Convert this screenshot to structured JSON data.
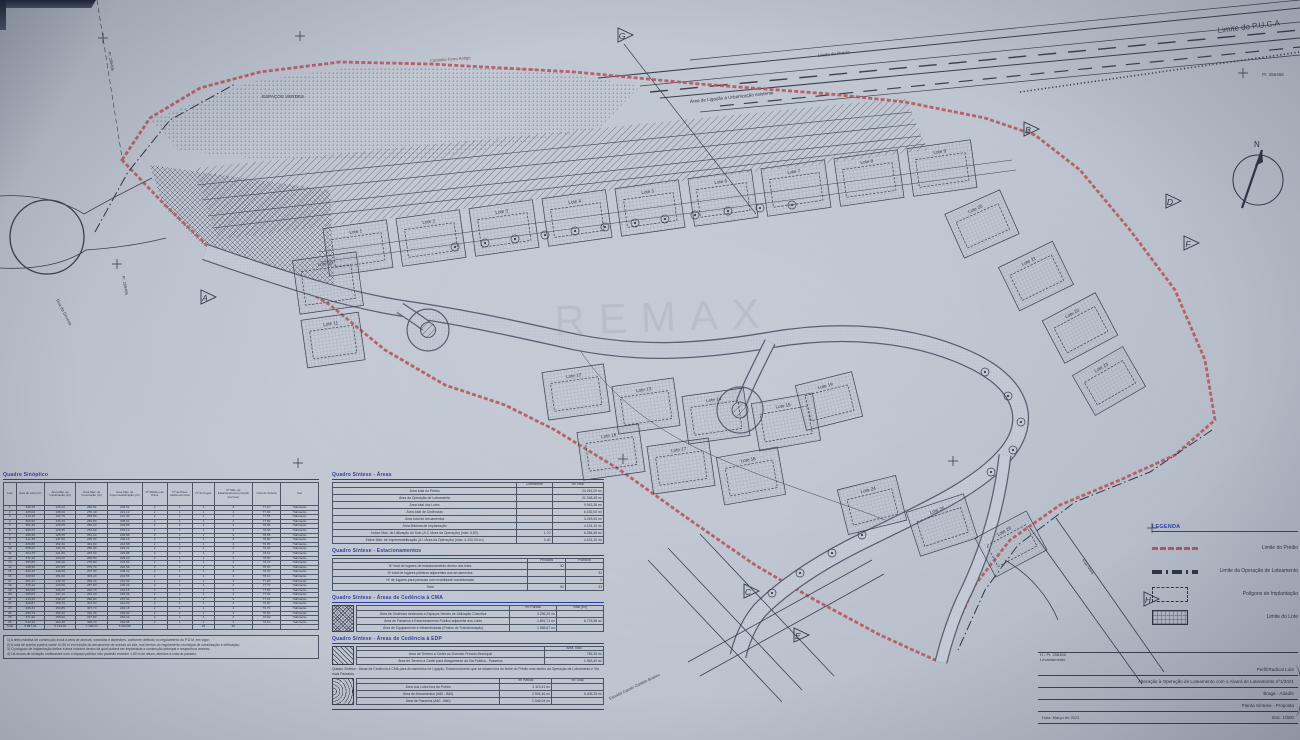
{
  "map": {
    "watermark": "REMAX",
    "north": "N",
    "labels": {
      "limite_puca": "Limite do P.U.C.A",
      "limite_predio": "Limite do Prédio",
      "caminho_ferro": "Caminho Ferro Antigo",
      "faixa_ligacao": "Área de Ligação à Urbanização existente",
      "espacos_verdes": "ESPAÇOS VERDES",
      "mark_topleft": "Pr. 256495",
      "mark_left": "Pr. 256495",
      "mark_topright": "Pr. 256466",
      "rua_esquerda": "Rua da Devesa",
      "estrada_baixo": "Estrada Camilo Castelo Branco",
      "rua_direita": "Rua Nova"
    },
    "section_markers": [
      "A",
      "B",
      "C",
      "D",
      "E",
      "F",
      "G",
      "H"
    ],
    "lots": [
      "Lote 1",
      "Lote 2",
      "Lote 3",
      "Lote 4",
      "Lote 5",
      "Lote 6",
      "Lote 7",
      "Lote 8",
      "Lote 9",
      "Lote 10",
      "Lote 11",
      "Lote 12",
      "Lote 13",
      "Lote 14",
      "Lote 15",
      "Lote 16",
      "Lote 17",
      "Lote 18",
      "Lote 19",
      "Lote 20",
      "Lote 21",
      "Lote 22",
      "Lote 23",
      "Lote 24",
      "Lote 25",
      "Lote 26"
    ]
  },
  "quadro_sinoptico": {
    "title": "Quadro Sinóptico",
    "headers": [
      "Lote",
      "Área do Lote (m²)",
      "Área Máx. de Implantação (m²)",
      "Área Máx. de Construção (m²)",
      "Área Máx. de Impermeabilização (m²)",
      "Nº Máximo de Pisos",
      "Nº de Pisos abaixo da Cota",
      "Nº de Fogos",
      "Nº Máx. de Estacionamento privado (por lote)",
      "Cota de Soleira",
      "Uso"
    ],
    "rows": [
      [
        "1",
        "348,16",
        "145,32",
        "290,64",
        "232,51",
        "2",
        "1",
        "1",
        "2",
        "77,10",
        "Habitação"
      ],
      [
        "2",
        "325,04",
        "138,20",
        "276,40",
        "221,12",
        "2",
        "1",
        "1",
        "2",
        "77,30",
        "Habitação"
      ],
      [
        "3",
        "312,48",
        "132,75",
        "265,50",
        "212,40",
        "2",
        "1",
        "1",
        "2",
        "77,55",
        "Habitação"
      ],
      [
        "4",
        "306,90",
        "130,40",
        "260,80",
        "208,64",
        "2",
        "1",
        "1",
        "2",
        "77,80",
        "Habitação"
      ],
      [
        "5",
        "301,25",
        "128,05",
        "256,10",
        "204,88",
        "2",
        "1",
        "1",
        "2",
        "78,05",
        "Habitação"
      ],
      [
        "6",
        "298,70",
        "126,95",
        "253,90",
        "203,12",
        "2",
        "1",
        "1",
        "2",
        "78,30",
        "Habitação"
      ],
      [
        "7",
        "295,40",
        "125,55",
        "251,10",
        "200,88",
        "2",
        "1",
        "1",
        "2",
        "78,55",
        "Habitação"
      ],
      [
        "8",
        "412,35",
        "147,60",
        "295,20",
        "236,16",
        "2",
        "1",
        "1",
        "2",
        "78,80",
        "Habitação"
      ],
      [
        "9",
        "436,80",
        "152,30",
        "304,60",
        "243,68",
        "2",
        "1",
        "1",
        "2",
        "79,05",
        "Habitação"
      ],
      [
        "10",
        "358,22",
        "140,15",
        "280,30",
        "224,24",
        "2",
        "1",
        "1",
        "2",
        "79,30",
        "Habitação"
      ],
      [
        "11",
        "364,75",
        "141,80",
        "283,60",
        "226,88",
        "2",
        "1",
        "1",
        "2",
        "79,10",
        "Habitação"
      ],
      [
        "12",
        "371,10",
        "143,25",
        "286,50",
        "229,20",
        "2",
        "1",
        "1",
        "2",
        "78,90",
        "Habitação"
      ],
      [
        "13",
        "355,65",
        "139,40",
        "278,80",
        "223,04",
        "2",
        "1",
        "1",
        "2",
        "78,70",
        "Habitação"
      ],
      [
        "14",
        "348,90",
        "137,85",
        "275,70",
        "220,56",
        "2",
        "1",
        "1",
        "2",
        "78,50",
        "Habitação"
      ],
      [
        "15",
        "420,16",
        "148,95",
        "297,90",
        "238,32",
        "2",
        "1",
        "1",
        "2",
        "78,30",
        "Habitação"
      ],
      [
        "16",
        "433,52",
        "151,60",
        "303,20",
        "242,56",
        "2",
        "1",
        "1",
        "2",
        "78,10",
        "Habitação"
      ],
      [
        "17",
        "381,27",
        "144,70",
        "289,40",
        "231,52",
        "2",
        "1",
        "1",
        "2",
        "77,90",
        "Habitação"
      ],
      [
        "18",
        "376,44",
        "143,90",
        "287,80",
        "230,24",
        "2",
        "1",
        "1",
        "2",
        "77,70",
        "Habitação"
      ],
      [
        "19",
        "392,08",
        "146,35",
        "292,70",
        "234,16",
        "2",
        "1",
        "1",
        "2",
        "77,50",
        "Habitação"
      ],
      [
        "20",
        "405,63",
        "147,10",
        "294,20",
        "235,36",
        "2",
        "1",
        "1",
        "2",
        "77,30",
        "Habitação"
      ],
      [
        "21",
        "414,29",
        "148,40",
        "296,80",
        "237,44",
        "2",
        "1",
        "1",
        "2",
        "77,10",
        "Habitação"
      ],
      [
        "22",
        "428,87",
        "150,75",
        "301,50",
        "241,20",
        "2",
        "1",
        "1",
        "2",
        "76,90",
        "Habitação"
      ],
      [
        "23",
        "446,31",
        "153,85",
        "307,70",
        "246,16",
        "2",
        "1",
        "1",
        "2",
        "76,70",
        "Habitação"
      ],
      [
        "24",
        "458,74",
        "156,20",
        "312,40",
        "249,92",
        "2",
        "1",
        "1",
        "2",
        "76,50",
        "Habitação"
      ],
      [
        "25",
        "471,92",
        "158,90",
        "317,80",
        "254,24",
        "2",
        "1",
        "1",
        "2",
        "76,30",
        "Habitação"
      ],
      [
        "26",
        "512,45",
        "164,35",
        "328,70",
        "262,96",
        "2",
        "1",
        "1",
        "2",
        "76,10",
        "Habitação"
      ],
      [
        "Total",
        "9.857,43",
        "3.744,32",
        "7.488,64",
        "5.990,89",
        "-",
        "-",
        "26",
        "52",
        "-",
        "-"
      ]
    ],
    "notes": "1) A área máxima de construção inclui a área de anexos, varandas e alpendres, conforme definido no regulamento do P.D.M. em vigor;\n2) A cota de soleira poderá variar ±0,50 m em função do arruamento de acesso ao lote, nos termos do regulamento municipal de urbanização e edificação;\n3) O polígono de implantação define a área máxima dentro da qual poderá ser implantada a construção principal e respectivos anexos;\n4) Os muros de vedação confinantes com o espaço público não poderão exceder 1,50 m de altura, aferidos à cota do passeio."
  },
  "quadro_areas": {
    "title": "Quadro Síntese - Áreas",
    "headers": [
      "",
      "Coeficiente",
      "m² Total"
    ],
    "rows": [
      [
        "Área total do Prédio",
        "",
        "24.261,00 m²"
      ],
      [
        "Área da Operação de Loteamento",
        "",
        "21.048,45 m²"
      ],
      [
        "Área total dos Lotes",
        "",
        "9.943,36 m²"
      ],
      [
        "Área total de Cedências",
        "",
        "6.152,00 m²"
      ],
      [
        "Área total de Arruamentos",
        "",
        "3.253,60 m²"
      ],
      [
        "Área Máxima de Implantação",
        "",
        "4.151,10 m²"
      ],
      [
        "Índice Máx. de Utilização do Solo (A.C./Área da Operação) (máx. 0,80)",
        "1,70",
        "6.284,65 m²"
      ],
      [
        "Índice Máx. de Impermeabilização (A.I./Área da Operação) (máx. 4.200,00 m²)",
        "0,40",
        "4.151,10 m²"
      ]
    ]
  },
  "quadro_estacionamentos": {
    "title": "Quadro Síntese - Estacionamentos",
    "headers": [
      "",
      "Privados",
      "Públicos"
    ],
    "rows": [
      [
        "Nº total de lugares de estacionamento dentro dos lotes",
        "52",
        ""
      ],
      [
        "Nº total de lugares públicos adjacentes aos arruamentos",
        "",
        "31"
      ],
      [
        "Nº de lugares para pessoas com mobilidade condicionada",
        "",
        "2"
      ],
      [
        "Total",
        "52",
        "33"
      ]
    ]
  },
  "quadro_cedencia_cma": {
    "title": "Quadro Síntese - Áreas de Cedência à CMA",
    "headers": [
      "",
      "m² Parcial",
      "Total (m²)"
    ],
    "rows": [
      [
        "Área de Cedência destinada a Espaços Verdes de Utilização Colectiva",
        "3.296,20 m²",
        ""
      ],
      [
        "Área de Passeios e Estacionamento Público adjacente aos Lotes",
        "1.891,71 m²",
        "6.776,58 m²"
      ],
      [
        "Área de Equipamento e Infraestruturas (Postos de Transformação)",
        "1.588,67 m²",
        ""
      ]
    ]
  },
  "quadro_cedencia_edp": {
    "title": "Quadro Síntese - Áreas de Cedência à EDP",
    "headers": [
      "",
      "Área Total"
    ],
    "rows": [
      [
        "Área de Terreno a Ceder ao Domínio Privado Municipal",
        "785,36 m²"
      ],
      [
        "Área de Terreno a Ceder para Alargamento da Via Pública - Passeios",
        "1.963,40 m²"
      ]
    ],
    "paragraph": "Quadro Síntese - Áreas de Cedência à CMA para Arruamentos de Ligação, Estacionamento que se situam fora do limite do Prédio mas dentro da Operação de Loteamento e Via mais Passeios."
  },
  "quadro_fora_poligono": {
    "headers": [
      "",
      "m² Parcial",
      "m² Total"
    ],
    "rows": [
      [
        "Área dos Lotes fora do Prédio",
        "3.119,41 m²",
        ""
      ],
      [
        "Área de Arruamentos (A60 - B60)",
        "2.904,46 m²",
        "6.406,25 m²"
      ],
      [
        "Área de Passeios (A60 - B60)",
        "1.046,04 m²",
        ""
      ]
    ]
  },
  "legend": {
    "title": "LEGENDA",
    "items": [
      {
        "key": "red-dash-line",
        "label": "Limite do Prédio"
      },
      {
        "key": "dash-dot-line",
        "label": "Limite da Operação de Loteamento"
      },
      {
        "key": "dashed-rect",
        "label": "Polígono de Implantação"
      },
      {
        "key": "grid-rect",
        "label": "Limite do Lote"
      }
    ]
  },
  "title_block": {
    "proc_line1": "H.- Pr. 256466",
    "proc_line2": "Levantamento",
    "row1": "Perfil/Radical Lote",
    "row2": "Alteração à Operação de Loteamento com o Alvará de Loteamento nº1/2021",
    "row3": "Braga - Adaúfe",
    "row4": "Planta Síntese - Proposta",
    "date": "Data: Março de 2023",
    "scale": "Esc. 1/500"
  }
}
